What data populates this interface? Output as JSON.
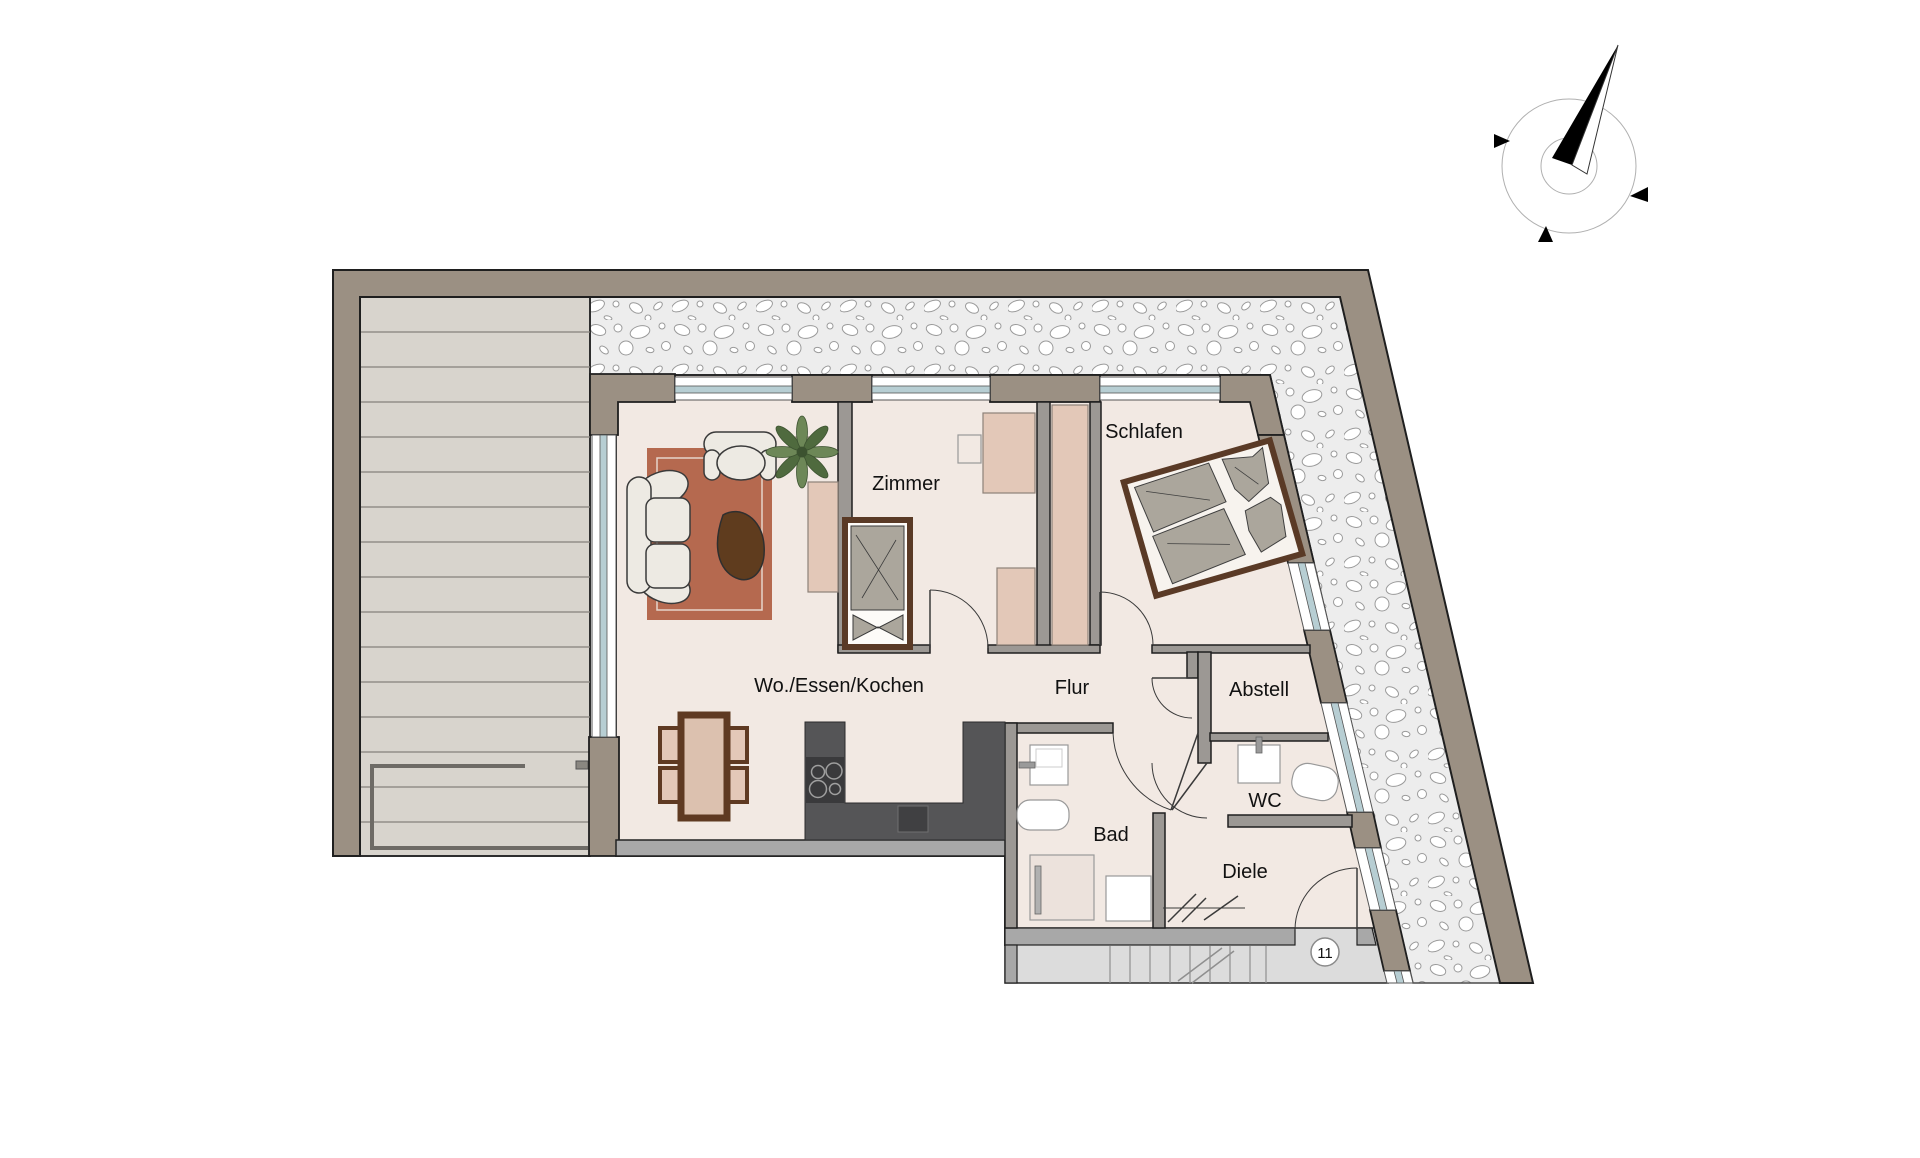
{
  "rooms": [
    {
      "id": "wohnen",
      "label": "Wo./Essen/Kochen"
    },
    {
      "id": "zimmer",
      "label": "Zimmer"
    },
    {
      "id": "schlafen",
      "label": "Schlafen"
    },
    {
      "id": "flur",
      "label": "Flur"
    },
    {
      "id": "abstell",
      "label": "Abstell"
    },
    {
      "id": "wc",
      "label": "WC"
    },
    {
      "id": "bad",
      "label": "Bad"
    },
    {
      "id": "diele",
      "label": "Diele"
    }
  ],
  "unit": {
    "number": "11"
  },
  "compass": {
    "kind": "north-arrow"
  },
  "colors": {
    "outer_wall": "#9b9083",
    "partition_wall": "#9c9894",
    "floor": "#f2e9e3",
    "terrace": "#d8d4cd",
    "gravel_bg": "#ededed",
    "rug": "#b5694f",
    "wood": "#5a3a26",
    "furniture_tan": "#e3c8b8",
    "textile_gray": "#aba69c",
    "kitchen_counter": "#555557",
    "window_glass": "#b7ced3",
    "stair_floor": "#dcdcdc"
  }
}
